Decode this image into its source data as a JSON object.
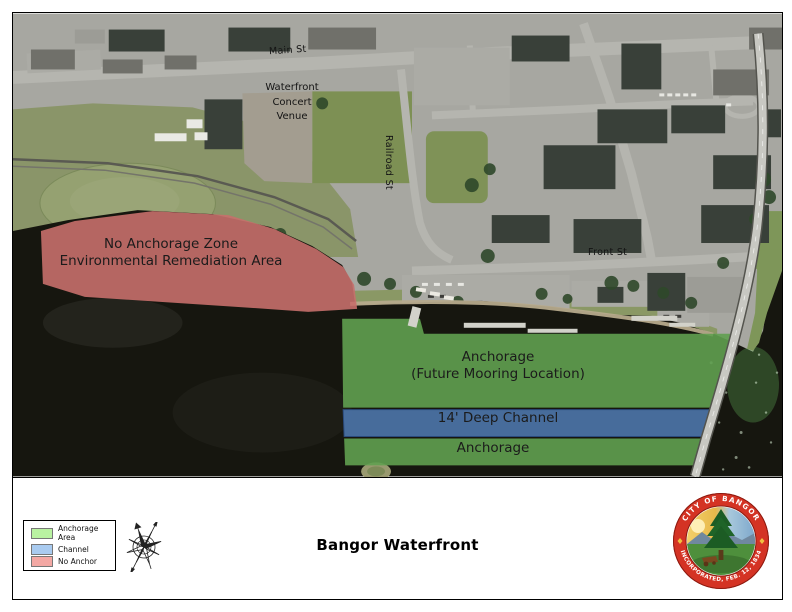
{
  "map": {
    "streets": {
      "main": "Main St",
      "railroad": "Railroad St",
      "front": "Front St"
    },
    "venue": {
      "line1": "Waterfront",
      "line2": "Concert",
      "line3": "Venue"
    },
    "zones": {
      "no_anchorage": {
        "line1": "No Anchorage Zone",
        "line2": "Environmental Remediation Area",
        "color": "#c66f6b"
      },
      "anchorage_north": {
        "line1": "Anchorage",
        "line2": "(Future Mooring Location)",
        "color": "#61a050"
      },
      "channel": {
        "label": "14' Deep Channel",
        "color": "#4d76ab"
      },
      "anchorage_south": {
        "label": "Anchorage",
        "color": "#61a050"
      }
    }
  },
  "footer": {
    "title": "Bangor Waterfront",
    "legend": {
      "items": [
        {
          "label": "Anchorage Area",
          "color": "#b9f2a1"
        },
        {
          "label": "Channel",
          "color": "#a9cbf0"
        },
        {
          "label": "No Anchor",
          "color": "#f3a8a4"
        }
      ]
    },
    "seal": {
      "top_text": "CITY OF BANGOR",
      "bottom_text": "INCORPORATED, FEB. 12, 1834"
    }
  }
}
